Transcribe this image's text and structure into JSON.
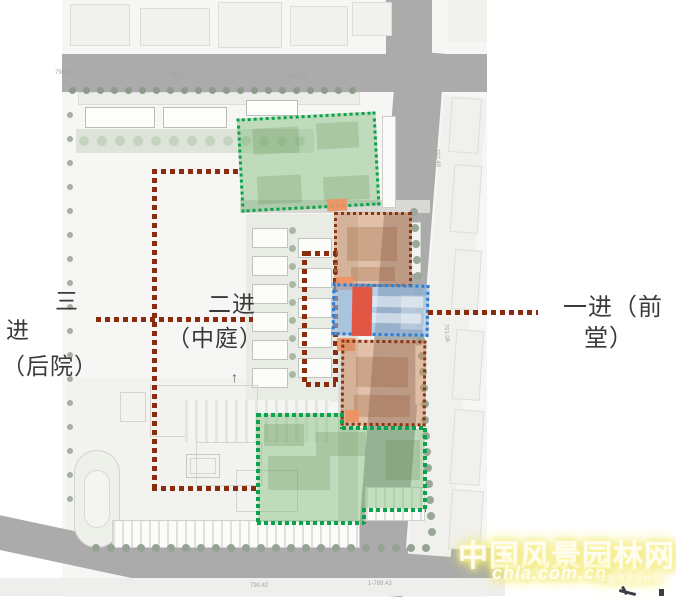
{
  "annotations": {
    "third": {
      "line1": "三",
      "line2": "进",
      "line3": "（后院）"
    },
    "second": {
      "line1": "二进",
      "line2": "（中庭）"
    },
    "first": {
      "line1": "一进（前",
      "line2": "堂）"
    }
  },
  "compass": {
    "north_arrow": "↑"
  },
  "road_marks": [
    "794.38",
    "791.11",
    "792.14",
    "792.48",
    "791.06",
    "790.42",
    "1-789.43"
  ],
  "watermark": {
    "site_name": "中国风景园林网",
    "site_url": "chla.com.cn",
    "site_name_small": "中国风景园林网"
  },
  "colors": {
    "leader": "#8a2d0e",
    "green-border": "#0aa24b",
    "green-fill": "rgba(124,186,119,0.45)",
    "orange-border": "#8a3512",
    "orange-fill": "rgba(205,137,94,0.5)",
    "blue-border": "#2d7cd2",
    "blue-fill": "rgba(138,180,225,0.6)",
    "red-axis": "#e25743",
    "salmon": "#ef9160",
    "road": "#ababab",
    "label-text": "#3a3a3a"
  }
}
